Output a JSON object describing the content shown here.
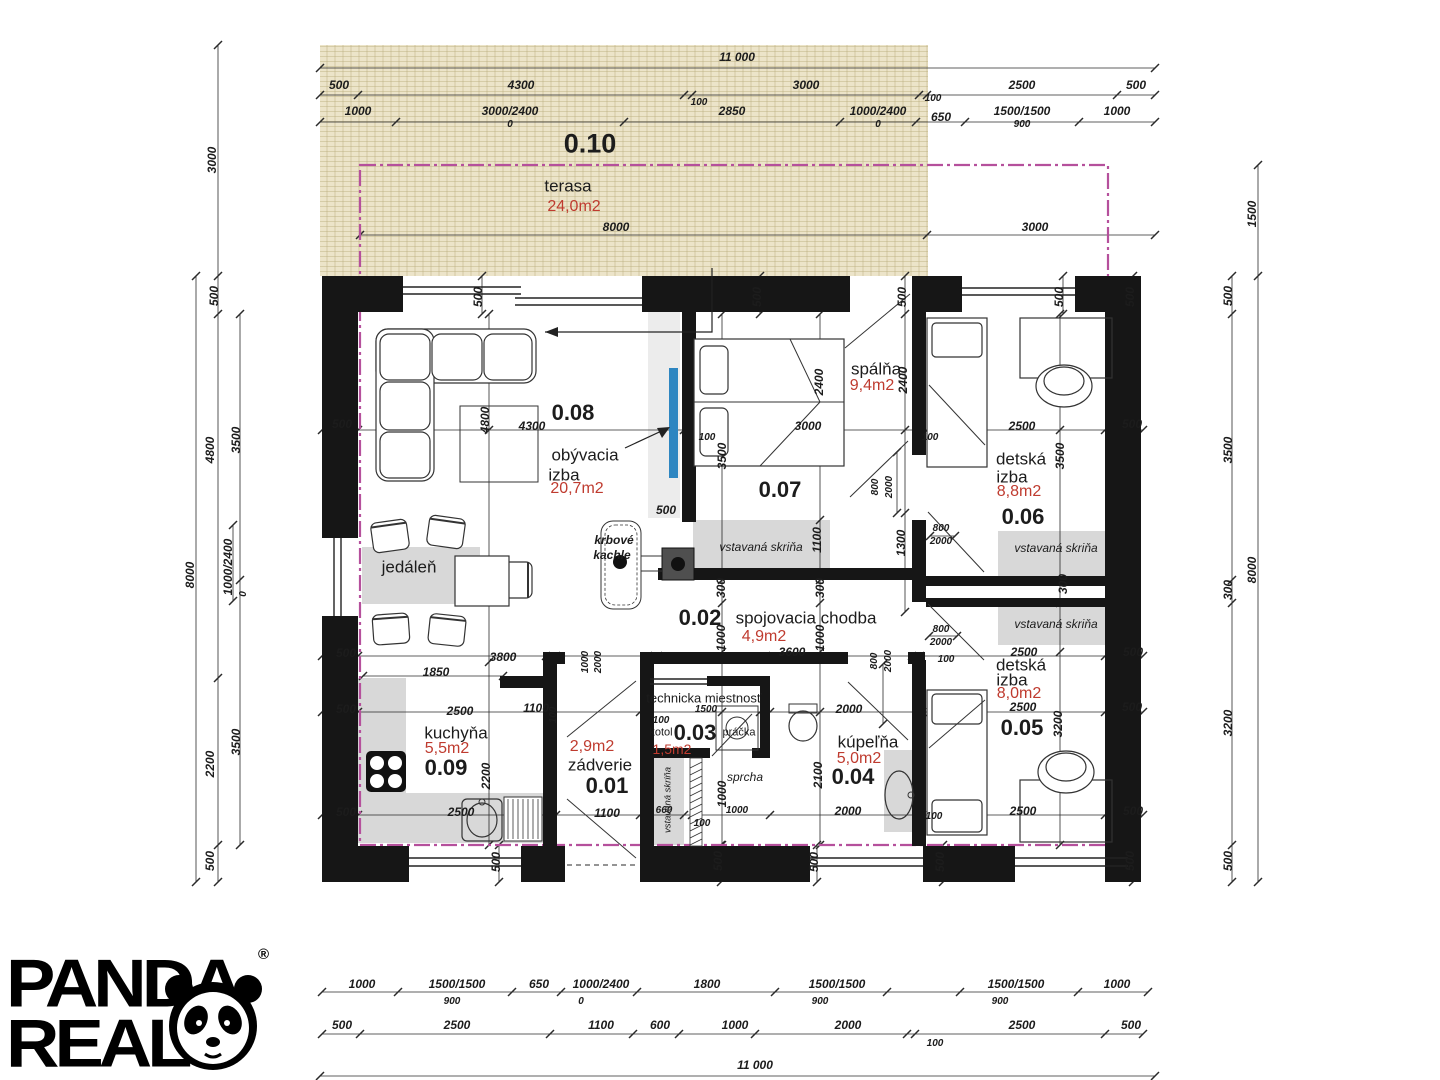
{
  "logo": {
    "line1": "PANDA",
    "line2": "REAL",
    "reg": "®"
  },
  "plan": {
    "rooms": [
      {
        "number": "0.01",
        "name": "zádverie",
        "area": "2,9m2"
      },
      {
        "number": "0.02",
        "name": "spojovacia chodba",
        "area": "4,9m2"
      },
      {
        "number": "0.03",
        "name": "technicka miestnosť",
        "area": "1,5m2",
        "items": [
          "kotol",
          "práčka"
        ]
      },
      {
        "number": "0.04",
        "name": "kúpeľňa",
        "area": "5,0m2",
        "items": [
          "sprcha"
        ]
      },
      {
        "number": "0.05",
        "name": "detská izba",
        "area": "8,0m2",
        "items": [
          "vstavaná skriňa"
        ]
      },
      {
        "number": "0.06",
        "name": "detská izba",
        "area": "8,8m2",
        "items": [
          "vstavaná skriňa"
        ]
      },
      {
        "number": "0.07",
        "name": "spálňa",
        "area": "9,4m2",
        "items": [
          "vstavaná skriňa"
        ]
      },
      {
        "number": "0.08",
        "name": "obývacia izba",
        "area": "20,7m2",
        "items": [
          "jedáleň",
          "krbové kachle"
        ]
      },
      {
        "number": "0.09",
        "name": "kuchyňa",
        "area": "5,5m2"
      },
      {
        "number": "0.10",
        "name": "terasa",
        "area": "24,0m2"
      }
    ],
    "overall_dimensions": {
      "width": "11 000",
      "height": "8000",
      "terrace_depth": "3000"
    }
  },
  "colors": {
    "area_text": "#bf3b2f",
    "boundary": "#b5509c",
    "terrace": "#ece4c9",
    "wall": "#161616",
    "fill_gray": "#d8d8d8",
    "blue_marker": "#2e86c1"
  },
  "labels": [
    [
      "11 000",
      737,
      57,
      "d"
    ],
    [
      "500",
      339,
      85,
      "d"
    ],
    [
      "4300",
      521,
      85,
      "d"
    ],
    [
      "3000",
      806,
      85,
      "d"
    ],
    [
      "2500",
      1022,
      85,
      "d"
    ],
    [
      "500",
      1136,
      85,
      "d"
    ],
    [
      "100",
      699,
      103,
      "ds"
    ],
    [
      "100",
      933,
      99,
      "ds"
    ],
    [
      "1000",
      358,
      111,
      "d"
    ],
    [
      "3000/2400",
      510,
      111,
      "d"
    ],
    [
      "0",
      510,
      125,
      "ds"
    ],
    [
      "2850",
      732,
      111,
      "d"
    ],
    [
      "1000/2400",
      878,
      111,
      "d"
    ],
    [
      "0",
      878,
      125,
      "ds"
    ],
    [
      "650",
      941,
      117,
      "d"
    ],
    [
      "1500/1500",
      1022,
      111,
      "d"
    ],
    [
      "900",
      1022,
      125,
      "ds"
    ],
    [
      "1000",
      1117,
      111,
      "d"
    ],
    [
      "0.10",
      590,
      144,
      "nl"
    ],
    [
      "terasa",
      568,
      186,
      "rn"
    ],
    [
      "24,0m2",
      574,
      207,
      "a"
    ],
    [
      "8000",
      616,
      227,
      "d"
    ],
    [
      "3000",
      1035,
      227,
      "d"
    ],
    [
      "1000",
      362,
      984,
      "d"
    ],
    [
      "1500/1500",
      457,
      984,
      "d"
    ],
    [
      "900",
      452,
      1002,
      "ds"
    ],
    [
      "650",
      539,
      984,
      "d"
    ],
    [
      "1000/2400",
      601,
      984,
      "d"
    ],
    [
      "0",
      581,
      1002,
      "ds"
    ],
    [
      "1800",
      707,
      984,
      "d"
    ],
    [
      "1500/1500",
      837,
      984,
      "d"
    ],
    [
      "900",
      820,
      1002,
      "ds"
    ],
    [
      "1500/1500",
      1016,
      984,
      "d"
    ],
    [
      "900",
      1000,
      1002,
      "ds"
    ],
    [
      "1000",
      1117,
      984,
      "d"
    ],
    [
      "500",
      342,
      1025,
      "d"
    ],
    [
      "2500",
      457,
      1025,
      "d"
    ],
    [
      "1100",
      601,
      1025,
      "d"
    ],
    [
      "600",
      660,
      1025,
      "d"
    ],
    [
      "1000",
      735,
      1025,
      "d"
    ],
    [
      "2000",
      848,
      1025,
      "d"
    ],
    [
      "100",
      935,
      1044,
      "ds"
    ],
    [
      "2500",
      1022,
      1025,
      "d"
    ],
    [
      "500",
      1131,
      1025,
      "d"
    ],
    [
      "11 000",
      755,
      1065,
      "d"
    ],
    [
      "8000",
      190,
      575,
      "d",
      1
    ],
    [
      "3000",
      212,
      160,
      "d",
      1
    ],
    [
      "500",
      214,
      296,
      "d",
      1
    ],
    [
      "4800",
      210,
      450,
      "d",
      1
    ],
    [
      "3500",
      236,
      440,
      "d",
      1
    ],
    [
      "1000/2400",
      228,
      567,
      "d",
      1
    ],
    [
      "0",
      244,
      594,
      "ds",
      1
    ],
    [
      "2200",
      210,
      764,
      "d",
      1
    ],
    [
      "3500",
      236,
      742,
      "d",
      1
    ],
    [
      "500",
      210,
      861,
      "d",
      1
    ],
    [
      "1500",
      1252,
      214,
      "d",
      1
    ],
    [
      "8000",
      1252,
      570,
      "d",
      1
    ],
    [
      "500",
      1228,
      296,
      "d",
      1
    ],
    [
      "3500",
      1228,
      450,
      "d",
      1
    ],
    [
      "300",
      1228,
      590,
      "d",
      1
    ],
    [
      "3200",
      1228,
      723,
      "d",
      1
    ],
    [
      "500",
      1228,
      861,
      "d",
      1
    ],
    [
      "500",
      478,
      297,
      "d",
      1
    ],
    [
      "500",
      757,
      297,
      "d",
      1
    ],
    [
      "500",
      902,
      297,
      "d",
      1
    ],
    [
      "500",
      1059,
      297,
      "d",
      1
    ],
    [
      "500",
      1130,
      297,
      "d",
      1
    ],
    [
      "500",
      496,
      862,
      "d",
      1
    ],
    [
      "500",
      718,
      861,
      "d",
      1
    ],
    [
      "500",
      814,
      862,
      "d",
      1
    ],
    [
      "500",
      940,
      862,
      "d",
      1
    ],
    [
      "500",
      1130,
      861,
      "d",
      1
    ],
    [
      "500",
      342,
      424,
      "d"
    ],
    [
      "500",
      346,
      653,
      "d"
    ],
    [
      "500",
      346,
      709,
      "d"
    ],
    [
      "500",
      346,
      812,
      "d"
    ],
    [
      "500",
      1132,
      424,
      "d"
    ],
    [
      "500",
      1133,
      652,
      "d"
    ],
    [
      "500",
      1132,
      707,
      "d"
    ],
    [
      "500",
      1133,
      811,
      "d"
    ],
    [
      "0.08",
      573,
      413,
      "n"
    ],
    [
      "obývacia",
      585,
      455,
      "rn"
    ],
    [
      "izba",
      564,
      475,
      "rn"
    ],
    [
      "20,7m2",
      577,
      489,
      "a"
    ],
    [
      "jedáleň",
      409,
      567,
      "rn"
    ],
    [
      "krbové",
      614,
      540,
      "f"
    ],
    [
      "kachle",
      612,
      555,
      "f"
    ],
    [
      "4800",
      485,
      420,
      "d",
      1
    ],
    [
      "4300",
      532,
      426,
      "d"
    ],
    [
      "3800",
      503,
      657,
      "d"
    ],
    [
      "1850",
      436,
      672,
      "d"
    ],
    [
      "500",
      666,
      510,
      "d"
    ],
    [
      "100",
      707,
      438,
      "ds"
    ],
    [
      "3500",
      722,
      456,
      "d",
      1
    ],
    [
      "spálňa",
      876,
      369,
      "rn"
    ],
    [
      "9,4m2",
      872,
      386,
      "a"
    ],
    [
      "0.07",
      780,
      490,
      "n"
    ],
    [
      "2400",
      819,
      382,
      "d",
      1
    ],
    [
      "2400",
      903,
      380,
      "d",
      1
    ],
    [
      "3000",
      808,
      426,
      "d"
    ],
    [
      "100",
      930,
      438,
      "ds"
    ],
    [
      "800",
      876,
      487,
      "ds",
      1
    ],
    [
      "2000",
      890,
      487,
      "ds",
      1
    ],
    [
      "1300",
      901,
      543,
      "d",
      1
    ],
    [
      "1100",
      817,
      540,
      "d",
      1
    ],
    [
      "vstavaná skriňa",
      761,
      547,
      "w"
    ],
    [
      "detská",
      1021,
      459,
      "rn"
    ],
    [
      "izba",
      1012,
      477,
      "rn"
    ],
    [
      "8,8m2",
      1019,
      492,
      "a"
    ],
    [
      "0.06",
      1023,
      517,
      "n"
    ],
    [
      "2500",
      1022,
      426,
      "d"
    ],
    [
      "vstavaná skriňa",
      1056,
      548,
      "w"
    ],
    [
      "3500",
      1060,
      456,
      "d",
      1
    ],
    [
      "300",
      1063,
      584,
      "d",
      1
    ],
    [
      "800",
      941,
      529,
      "ds"
    ],
    [
      "2000",
      941,
      542,
      "ds"
    ],
    [
      "0.02",
      700,
      618,
      "n"
    ],
    [
      "spojovacia chodba",
      806,
      618,
      "rn"
    ],
    [
      "4,9m2",
      764,
      637,
      "a"
    ],
    [
      "3600",
      792,
      652,
      "d"
    ],
    [
      "1000",
      721,
      638,
      "d",
      1
    ],
    [
      "1000",
      820,
      638,
      "d",
      1
    ],
    [
      "300",
      721,
      588,
      "d",
      1
    ],
    [
      "300",
      820,
      588,
      "d",
      1
    ],
    [
      "1000",
      586,
      662,
      "ds",
      1
    ],
    [
      "2000",
      599,
      662,
      "ds",
      1
    ],
    [
      "technicka miestnosť",
      704,
      698,
      "rns"
    ],
    [
      "1500",
      706,
      710,
      "ds"
    ],
    [
      "100",
      661,
      721,
      "ds"
    ],
    [
      "kotol",
      661,
      733,
      "rnx"
    ],
    [
      "0.03",
      695,
      733,
      "n"
    ],
    [
      "práčka",
      739,
      733,
      "rnx"
    ],
    [
      "1,5m2",
      672,
      749,
      "as"
    ],
    [
      "2,9m2",
      592,
      747,
      "a"
    ],
    [
      "zádverie",
      600,
      765,
      "rn"
    ],
    [
      "0.01",
      607,
      786,
      "n"
    ],
    [
      "1100",
      536,
      708,
      "d"
    ],
    [
      "100",
      554,
      715,
      "ds",
      1
    ],
    [
      "1100",
      607,
      813,
      "d"
    ],
    [
      "660",
      664,
      811,
      "ds"
    ],
    [
      "100",
      702,
      824,
      "ds"
    ],
    [
      "vstavaná skriňa",
      668,
      800,
      "ws",
      1
    ],
    [
      "1000",
      722,
      794,
      "d",
      1
    ],
    [
      "1000",
      737,
      811,
      "ds"
    ],
    [
      "kúpeľňa",
      868,
      742,
      "rn"
    ],
    [
      "5,0m2",
      859,
      759,
      "a"
    ],
    [
      "0.04",
      853,
      777,
      "n"
    ],
    [
      "sprcha",
      745,
      777,
      "w"
    ],
    [
      "2000",
      849,
      709,
      "d"
    ],
    [
      "2100",
      818,
      775,
      "d",
      1
    ],
    [
      "2000",
      848,
      811,
      "d"
    ],
    [
      "800",
      875,
      661,
      "ds",
      1
    ],
    [
      "2000",
      889,
      661,
      "ds",
      1
    ],
    [
      "100",
      946,
      660,
      "ds"
    ],
    [
      "kuchyňa",
      456,
      733,
      "rn"
    ],
    [
      "5,5m2",
      447,
      749,
      "a"
    ],
    [
      "0.09",
      446,
      768,
      "n"
    ],
    [
      "2500",
      460,
      711,
      "d"
    ],
    [
      "2500",
      461,
      812,
      "d"
    ],
    [
      "2200",
      486,
      776,
      "d",
      1
    ],
    [
      "detská",
      1021,
      665,
      "rn"
    ],
    [
      "izba",
      1012,
      680,
      "rn"
    ],
    [
      "8,0m2",
      1019,
      694,
      "a"
    ],
    [
      "0.05",
      1022,
      728,
      "n"
    ],
    [
      "2500",
      1024,
      652,
      "d"
    ],
    [
      "2500",
      1023,
      707,
      "d"
    ],
    [
      "2500",
      1023,
      811,
      "d"
    ],
    [
      "3200",
      1058,
      724,
      "d",
      1
    ],
    [
      "vstavaná skriňa",
      1056,
      624,
      "w"
    ],
    [
      "800",
      941,
      630,
      "ds"
    ],
    [
      "2000",
      941,
      643,
      "ds"
    ],
    [
      "100",
      934,
      817,
      "ds"
    ]
  ]
}
